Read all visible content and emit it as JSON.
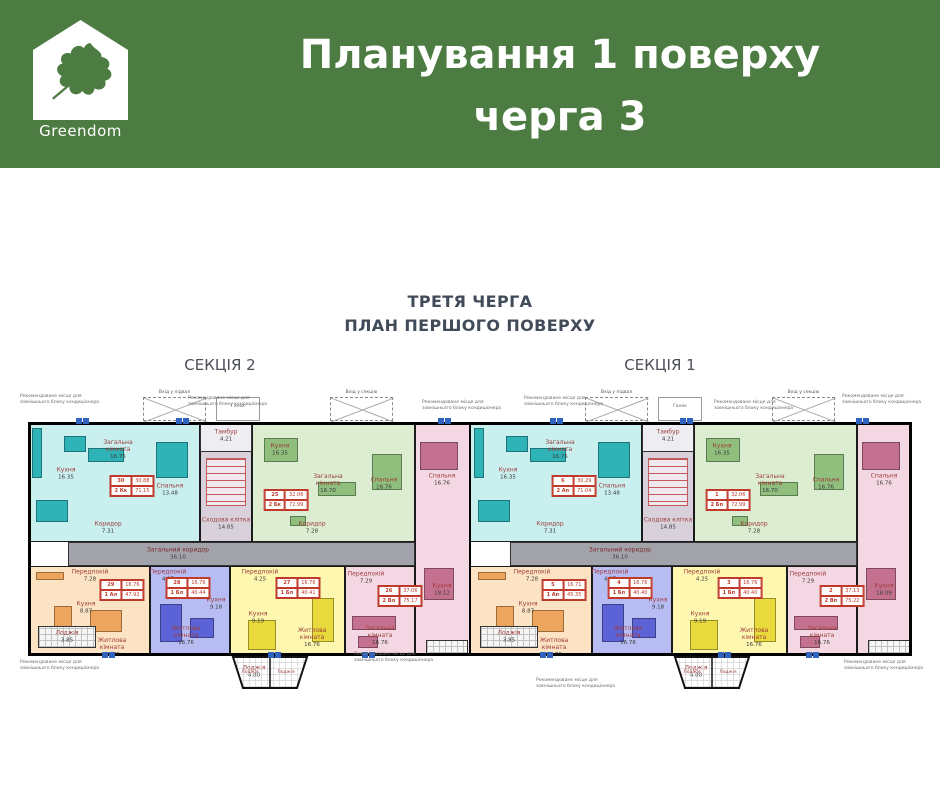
{
  "header": {
    "logo_text": "Greendom",
    "title_line1": "Планування 1 поверху",
    "title_line2": "черга 3",
    "bg_color": "#4d7c42"
  },
  "plan": {
    "title_line1": "ТРЕТЯ ЧЕРГА",
    "title_line2": "ПЛАН ПЕРШОГО ПОВЕРХУ"
  },
  "annotations": {
    "ac_note": "Рекомендоване місце для зовнішнього блоку кондиціонера",
    "entrance_basement": "Вхід у підвал",
    "entrance_section": "Вхід у секцію",
    "porch_label": "Ганок"
  },
  "palette": {
    "cyan": {
      "bg": "#c9efee",
      "accent": "#2fb3b6"
    },
    "green": {
      "bg": "#dcedd1",
      "accent": "#8fbe7d"
    },
    "pink": {
      "bg": "#f3d8e3",
      "accent": "#c4718f"
    },
    "orange": {
      "bg": "#fbe3c3",
      "accent": "#eda55e"
    },
    "blue": {
      "bg": "#b7bcf2",
      "accent": "#5c63d6"
    },
    "yellow": {
      "bg": "#fdf7b0",
      "accent": "#e8d93c"
    },
    "corridor": "#a2a2aa",
    "stair_bg": "#d8d1db",
    "wall": "#111111",
    "ac_unit": "#2f63bd"
  },
  "floorplan": {
    "corridor": {
      "name": "Загальний коридор",
      "area": "36.10"
    },
    "stair": {
      "tambour_name": "Тамбур",
      "tambour_area": "4.21",
      "stairwell_name": "Сходова клітка",
      "stairwell_area": "14.85"
    },
    "loggia_label": "Лоджія",
    "sections": [
      {
        "label": "СЕКЦІЯ 2",
        "apartments": [
          {
            "number": "30",
            "type": "2 Кк",
            "living_area": "30.88",
            "total_area": "71.15",
            "color_key": "cyan",
            "rooms": [
              {
                "name": "Кухня",
                "area": "16.35"
              },
              {
                "name": "Загальна кімната",
                "area": "16.75"
              },
              {
                "name": "Спальня",
                "area": "13.48"
              },
              {
                "name": "Коридор",
                "area": "7.31"
              }
            ]
          },
          {
            "number": "25",
            "type": "2 Бк",
            "living_area": "32.06",
            "total_area": "72.99",
            "color_key": "green",
            "rooms": [
              {
                "name": "Кухня",
                "area": "16.35"
              },
              {
                "name": "Загальна кімната",
                "area": "16.70"
              },
              {
                "name": "Спальня",
                "area": "16.76"
              },
              {
                "name": "Коридор",
                "area": "7.28"
              }
            ]
          },
          {
            "number": "26",
            "type": "2 Вл",
            "living_area": "37.06",
            "total_area": "75.17",
            "color_key": "pink",
            "rooms": [
              {
                "name": "Спальня",
                "area": "16.76"
              },
              {
                "name": "Кухня",
                "area": "18.12"
              },
              {
                "name": "Загальна кімната",
                "area": "16.76"
              },
              {
                "name": "Передпокій",
                "area": "7.29"
              }
            ]
          },
          {
            "number": "29",
            "type": "1 Ал",
            "living_area": "16.76",
            "total_area": "47.92",
            "color_key": "orange",
            "rooms": [
              {
                "name": "Передпокій",
                "area": "7.28"
              },
              {
                "name": "Кухня",
                "area": "8.87"
              },
              {
                "name": "Житлова кімната",
                "area": "16.76"
              },
              {
                "name": "Лоджія",
                "area": "3.85"
              }
            ]
          },
          {
            "number": "28",
            "type": "1 Бл",
            "living_area": "16.76",
            "total_area": "40.44",
            "color_key": "blue",
            "rooms": [
              {
                "name": "Передпокій",
                "area": "4.27"
              },
              {
                "name": "Житлова кімната",
                "area": "16.76"
              },
              {
                "name": "Кухня",
                "area": "9.18"
              }
            ]
          },
          {
            "number": "27",
            "type": "1 Бл",
            "living_area": "16.76",
            "total_area": "40.41",
            "color_key": "yellow",
            "rooms": [
              {
                "name": "Передпокій",
                "area": "4.25"
              },
              {
                "name": "Кухня",
                "area": "9.19"
              },
              {
                "name": "Житлова кімната",
                "area": "16.76"
              },
              {
                "name": "Лоджія",
                "area": "4.88"
              }
            ]
          }
        ]
      },
      {
        "label": "СЕКЦІЯ 1",
        "apartments": [
          {
            "number": "6",
            "type": "2 Ап",
            "living_area": "30.29",
            "total_area": "71.04",
            "color_key": "cyan",
            "rooms": [
              {
                "name": "Кухня",
                "area": "16.35"
              },
              {
                "name": "Загальна кімната",
                "area": "16.75"
              },
              {
                "name": "Спальня",
                "area": "13.48"
              },
              {
                "name": "Коридор",
                "area": "7.31"
              }
            ]
          },
          {
            "number": "1",
            "type": "2 Бп",
            "living_area": "32.06",
            "total_area": "72.99",
            "color_key": "green",
            "rooms": [
              {
                "name": "Кухня",
                "area": "16.35"
              },
              {
                "name": "Загальна кімната",
                "area": "16.70"
              },
              {
                "name": "Спальня",
                "area": "16.76"
              },
              {
                "name": "Коридор",
                "area": "7.28"
              }
            ]
          },
          {
            "number": "2",
            "type": "2 Вп",
            "living_area": "37.13",
            "total_area": "75.22",
            "color_key": "pink",
            "rooms": [
              {
                "name": "Спальня",
                "area": "16.76"
              },
              {
                "name": "Кухня",
                "area": "18.09"
              },
              {
                "name": "Загальна кімната",
                "area": "16.76"
              },
              {
                "name": "Передпокій",
                "area": "7.29"
              }
            ]
          },
          {
            "number": "5",
            "type": "1 Ап",
            "living_area": "16.71",
            "total_area": "45.35",
            "color_key": "orange",
            "rooms": [
              {
                "name": "Передпокій",
                "area": "7.28"
              },
              {
                "name": "Кухня",
                "area": "8.87"
              },
              {
                "name": "Житлова кімната",
                "area": "16.76"
              },
              {
                "name": "Лоджія",
                "area": "3.85"
              }
            ]
          },
          {
            "number": "4",
            "type": "1 Бп",
            "living_area": "16.76",
            "total_area": "40.40",
            "color_key": "blue",
            "rooms": [
              {
                "name": "Передпокій",
                "area": "4.27"
              },
              {
                "name": "Житлова кімната",
                "area": "16.76"
              },
              {
                "name": "Кухня",
                "area": "9.18"
              }
            ]
          },
          {
            "number": "3",
            "type": "1 Бп",
            "living_area": "16.76",
            "total_area": "40.40",
            "color_key": "yellow",
            "rooms": [
              {
                "name": "Передпокій",
                "area": "4.25"
              },
              {
                "name": "Кухня",
                "area": "9.19"
              },
              {
                "name": "Житлова кімната",
                "area": "16.76"
              },
              {
                "name": "Лоджія",
                "area": "4.88"
              }
            ]
          }
        ]
      }
    ]
  }
}
